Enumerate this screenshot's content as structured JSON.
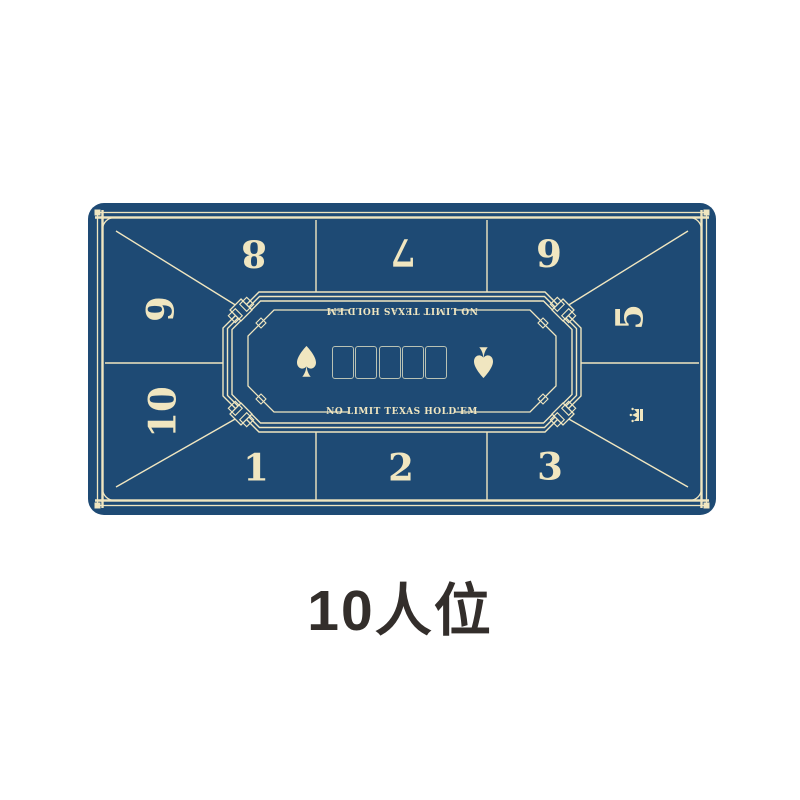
{
  "caption": {
    "text": "10人位"
  },
  "mat": {
    "track_title": "NO LIMIT TEXAS HOLD'EM",
    "seats": {
      "s1": "1",
      "s2": "2",
      "s3": "3",
      "s5": "5",
      "s6": "6",
      "s7": "7",
      "s8": "8",
      "s9": "9",
      "s10": "10"
    },
    "board_card_slots": 5,
    "icons": {
      "left_center": "spade-icon",
      "right_center": "spade-icon-inverted",
      "right_side": "crown-icon"
    },
    "colors": {
      "felt": "#1e4a74",
      "line": "#f0e6c0",
      "card_outline": "#b9c2b4",
      "caption_text": "#332e2b",
      "background": "#ffffff"
    }
  }
}
